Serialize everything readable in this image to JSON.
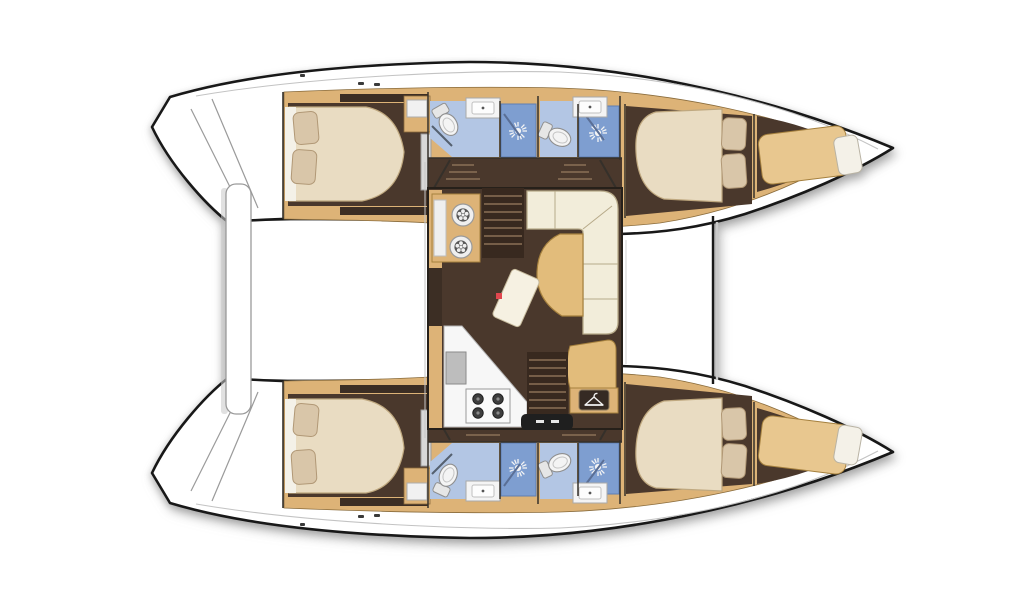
{
  "meta": {
    "type": "floorplan-diagram",
    "subject": "catamaran-yacht-interior-layout",
    "view": "top-down",
    "orientation": "bows-right-sterns-left"
  },
  "layout_summary": {
    "hulls": 2,
    "double_cabins": 4,
    "bathrooms_with_shower": 4,
    "bow_crew_berths": 2,
    "saloon_features": [
      "nav-desk-with-stools",
      "l-shaped-sofa",
      "dining-table",
      "ottoman",
      "chaise-pad",
      "wardrobe",
      "galley-counter",
      "sink",
      "four-burner-stove",
      "companionway-steps"
    ],
    "per_bathroom_fixtures": [
      "toilet",
      "sink-counter",
      "shower-stall"
    ]
  },
  "icons": [
    {
      "name": "shower-icon",
      "glyph": "sunburst"
    },
    {
      "name": "hanger-icon",
      "glyph": "clothes-hanger"
    },
    {
      "name": "burner-icon",
      "glyph": "filled-circle"
    },
    {
      "name": "stool-icon",
      "glyph": "flower-circle"
    },
    {
      "name": "cleat-icon",
      "glyph": "small-dark-dash"
    }
  ],
  "palette": {
    "page_bg": "#ffffff",
    "hull_outline": "#181818",
    "deck_white": "#ffffff",
    "walkway_line": "#c3c3c3",
    "wood": "#ddb377",
    "wood_stroke": "#8a6c3c",
    "wood_light": "#e8c78f",
    "floor_brown": "#4a382c",
    "floor_brown_dark": "#3c2e24",
    "wall_dark": "#35302a",
    "bed_cream": "#e9dcc2",
    "bed_stroke": "#bfa87f",
    "sheet_white": "#f4f1e8",
    "pillow_tan": "#d9c6a9",
    "pillow_stroke": "#b19876",
    "bath_blue": "#b3c6e4",
    "shower_blue": "#7e9ed0",
    "fixture_white": "#f4f4f4",
    "fixture_stroke": "#8f8f8f",
    "sofa_cream": "#f2edda",
    "sofa_stroke": "#b7aa89",
    "table_wood": "#e2bc7b",
    "table_stroke": "#a5803e",
    "steps_dark": "#38291f",
    "step_line": "#8a7057",
    "door_black": "#1f1f1f",
    "accent_red": "#e0474e",
    "counter_gray": "#bdbdbd",
    "shadow_gray": "#c9c9c9"
  }
}
